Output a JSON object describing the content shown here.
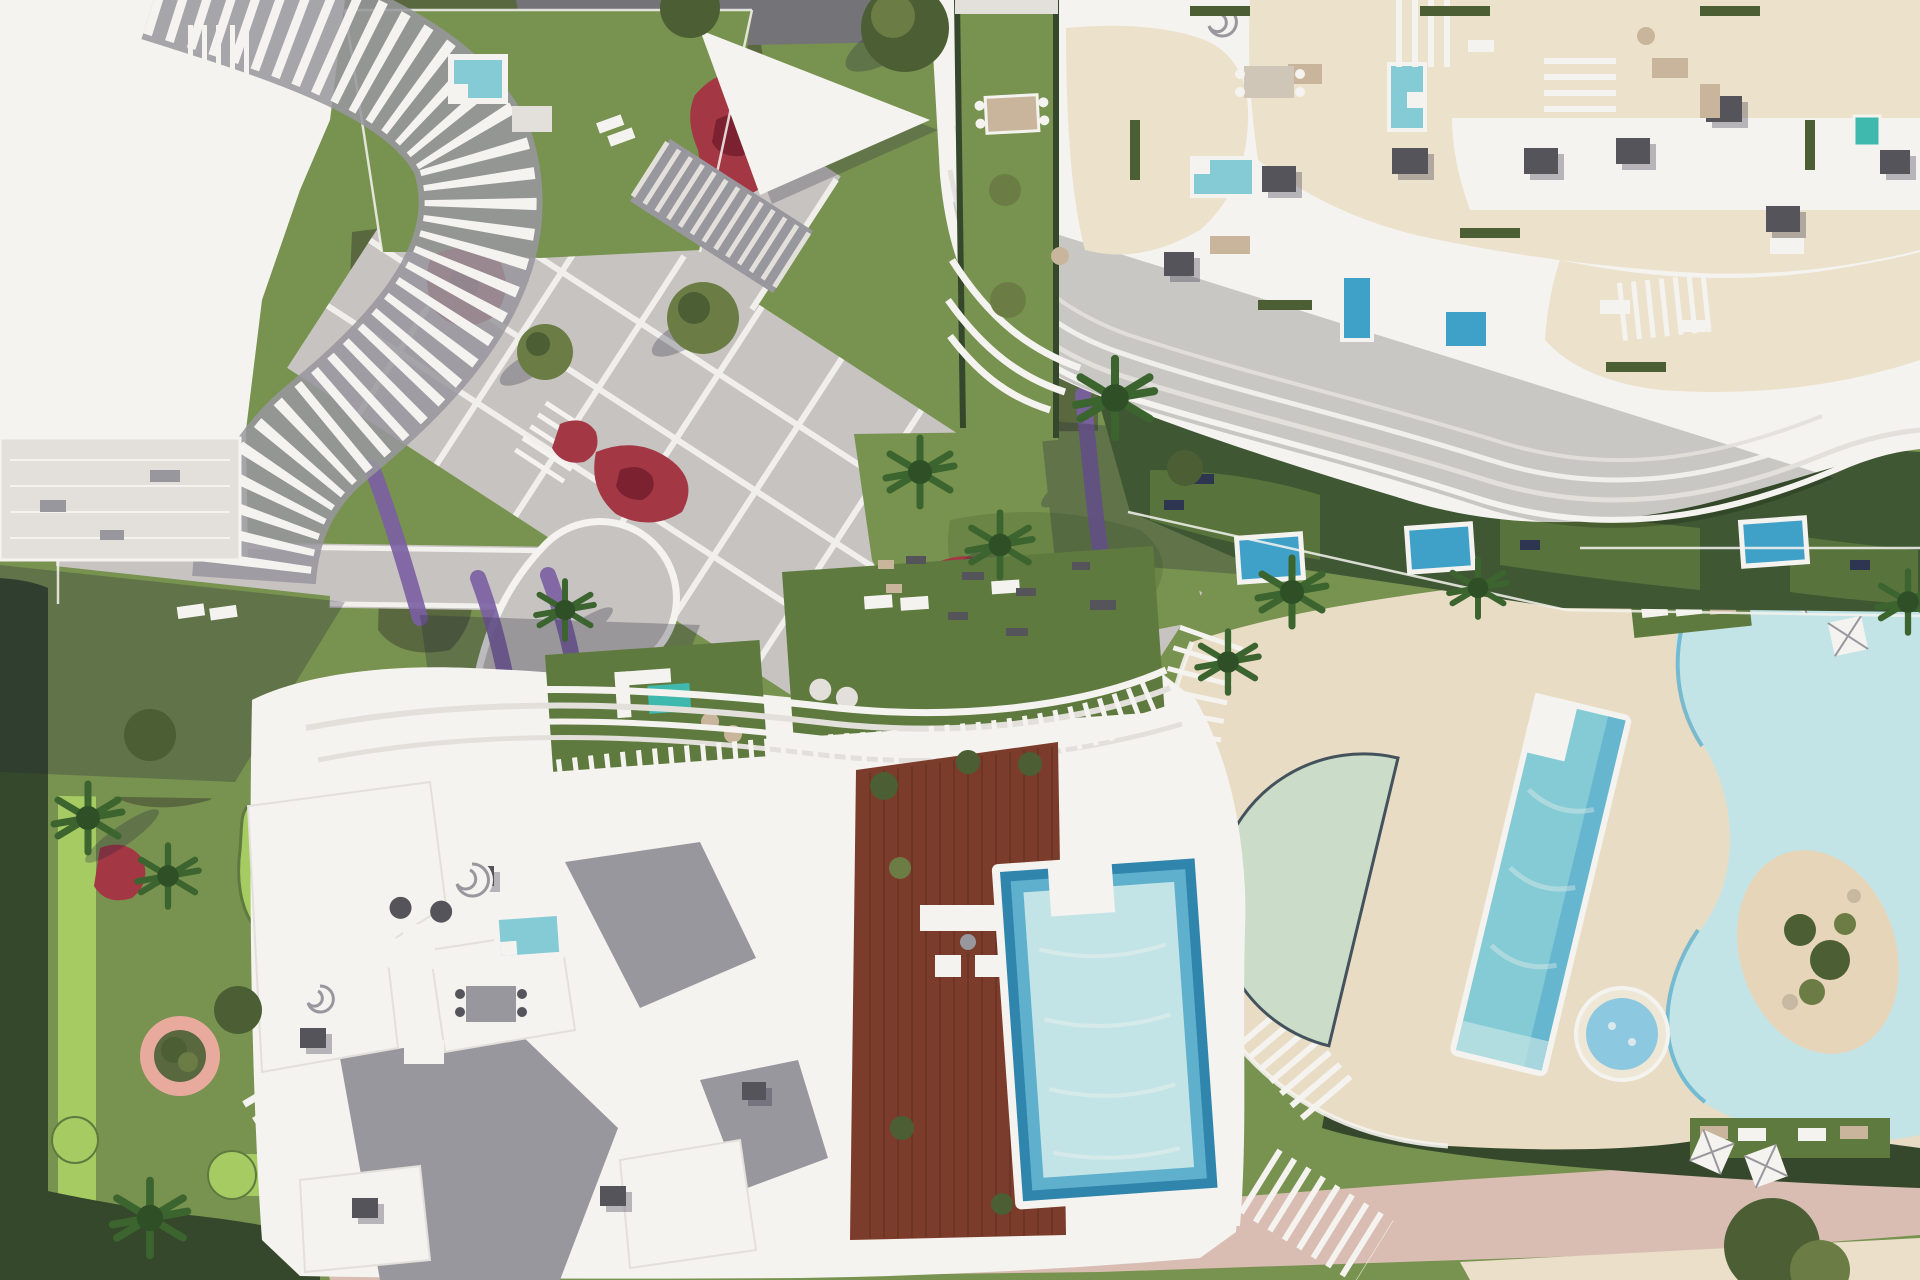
{
  "image": {
    "kind": "aerial-architectural-render",
    "view": "top-down",
    "subject": "residential resort complex with gardens, plazas and swimming pools",
    "visible_text": ""
  },
  "palette": {
    "grass": "#78924f",
    "grassDark": "#5f7a3e",
    "grassDeep": "#3f5733",
    "grassBright": "#a6cb63",
    "scrub": "#5a6840",
    "scrubPale": "#c6b8a1",
    "hedge": "#35482c",
    "flowerRed": "#a43744",
    "flowerDeepRed": "#7c2130",
    "flowerPurple": "#7a5fa3",
    "flowerPink": "#e9aa9e",
    "paving": "#c7c3c0",
    "line": "#f3f1ee",
    "white": "#f5f3ef",
    "offWhite": "#e3e0db",
    "cream": "#efe7d6",
    "creamTerrace": "#ece1cb",
    "creamDeck": "#e9dcc4",
    "slate": "#98979d",
    "roofBox": "#54545a",
    "road": "#747378",
    "wood": "#7b3c2b",
    "woodDark": "#552a1f",
    "poolTurquoise": "#85cbd5",
    "poolPale": "#c3e4e6",
    "poolMid": "#5fb0cd",
    "poolDeep": "#2f85ac",
    "poolPlunge": "#3fa0c8",
    "poolSage": "#cbdcc8",
    "poolRim": "#43525c",
    "sandIsland": "#e7d5ba",
    "boardwalk": "#d9bcb2",
    "sand": "#ecdfc9",
    "palm": "#3c642f",
    "palmDark": "#2f5026",
    "tree": "#6b7d44",
    "treeDark": "#4c5e33",
    "shadow": "#23243a",
    "tan": "#c9b59b",
    "teal": "#3fb8ad",
    "navy": "#2e3550",
    "stoneLight": "#cfc6b8"
  },
  "regions": [
    {
      "name": "building-north-west",
      "kind": "white apartment block with curved fin balconies"
    },
    {
      "name": "building-north-east",
      "kind": "white apartment block with wavy balconies and roof terraces"
    },
    {
      "name": "building-south",
      "kind": "white apartment block with pergolas, wood deck and rooftop pool"
    },
    {
      "name": "central-plaza",
      "kind": "diagonal paved plaza with white joints and olive trees"
    },
    {
      "name": "communal-pools",
      "kind": "lagoon pool, lap pool, shallow pool, jacuzzi with sand island"
    },
    {
      "name": "rooftop-pool",
      "kind": "stepped-edge infinity pool beside timber deck"
    },
    {
      "name": "mini-golf-garden",
      "kind": "putting greens and curved paths"
    },
    {
      "name": "outdoor-gym-lawn",
      "kind": "lawn with exercise mats"
    },
    {
      "name": "flower-beds",
      "kind": "red, crimson and purple planting"
    },
    {
      "name": "beach-boardwalk",
      "kind": "pink promenade and sand strip at bottom edge"
    }
  ]
}
